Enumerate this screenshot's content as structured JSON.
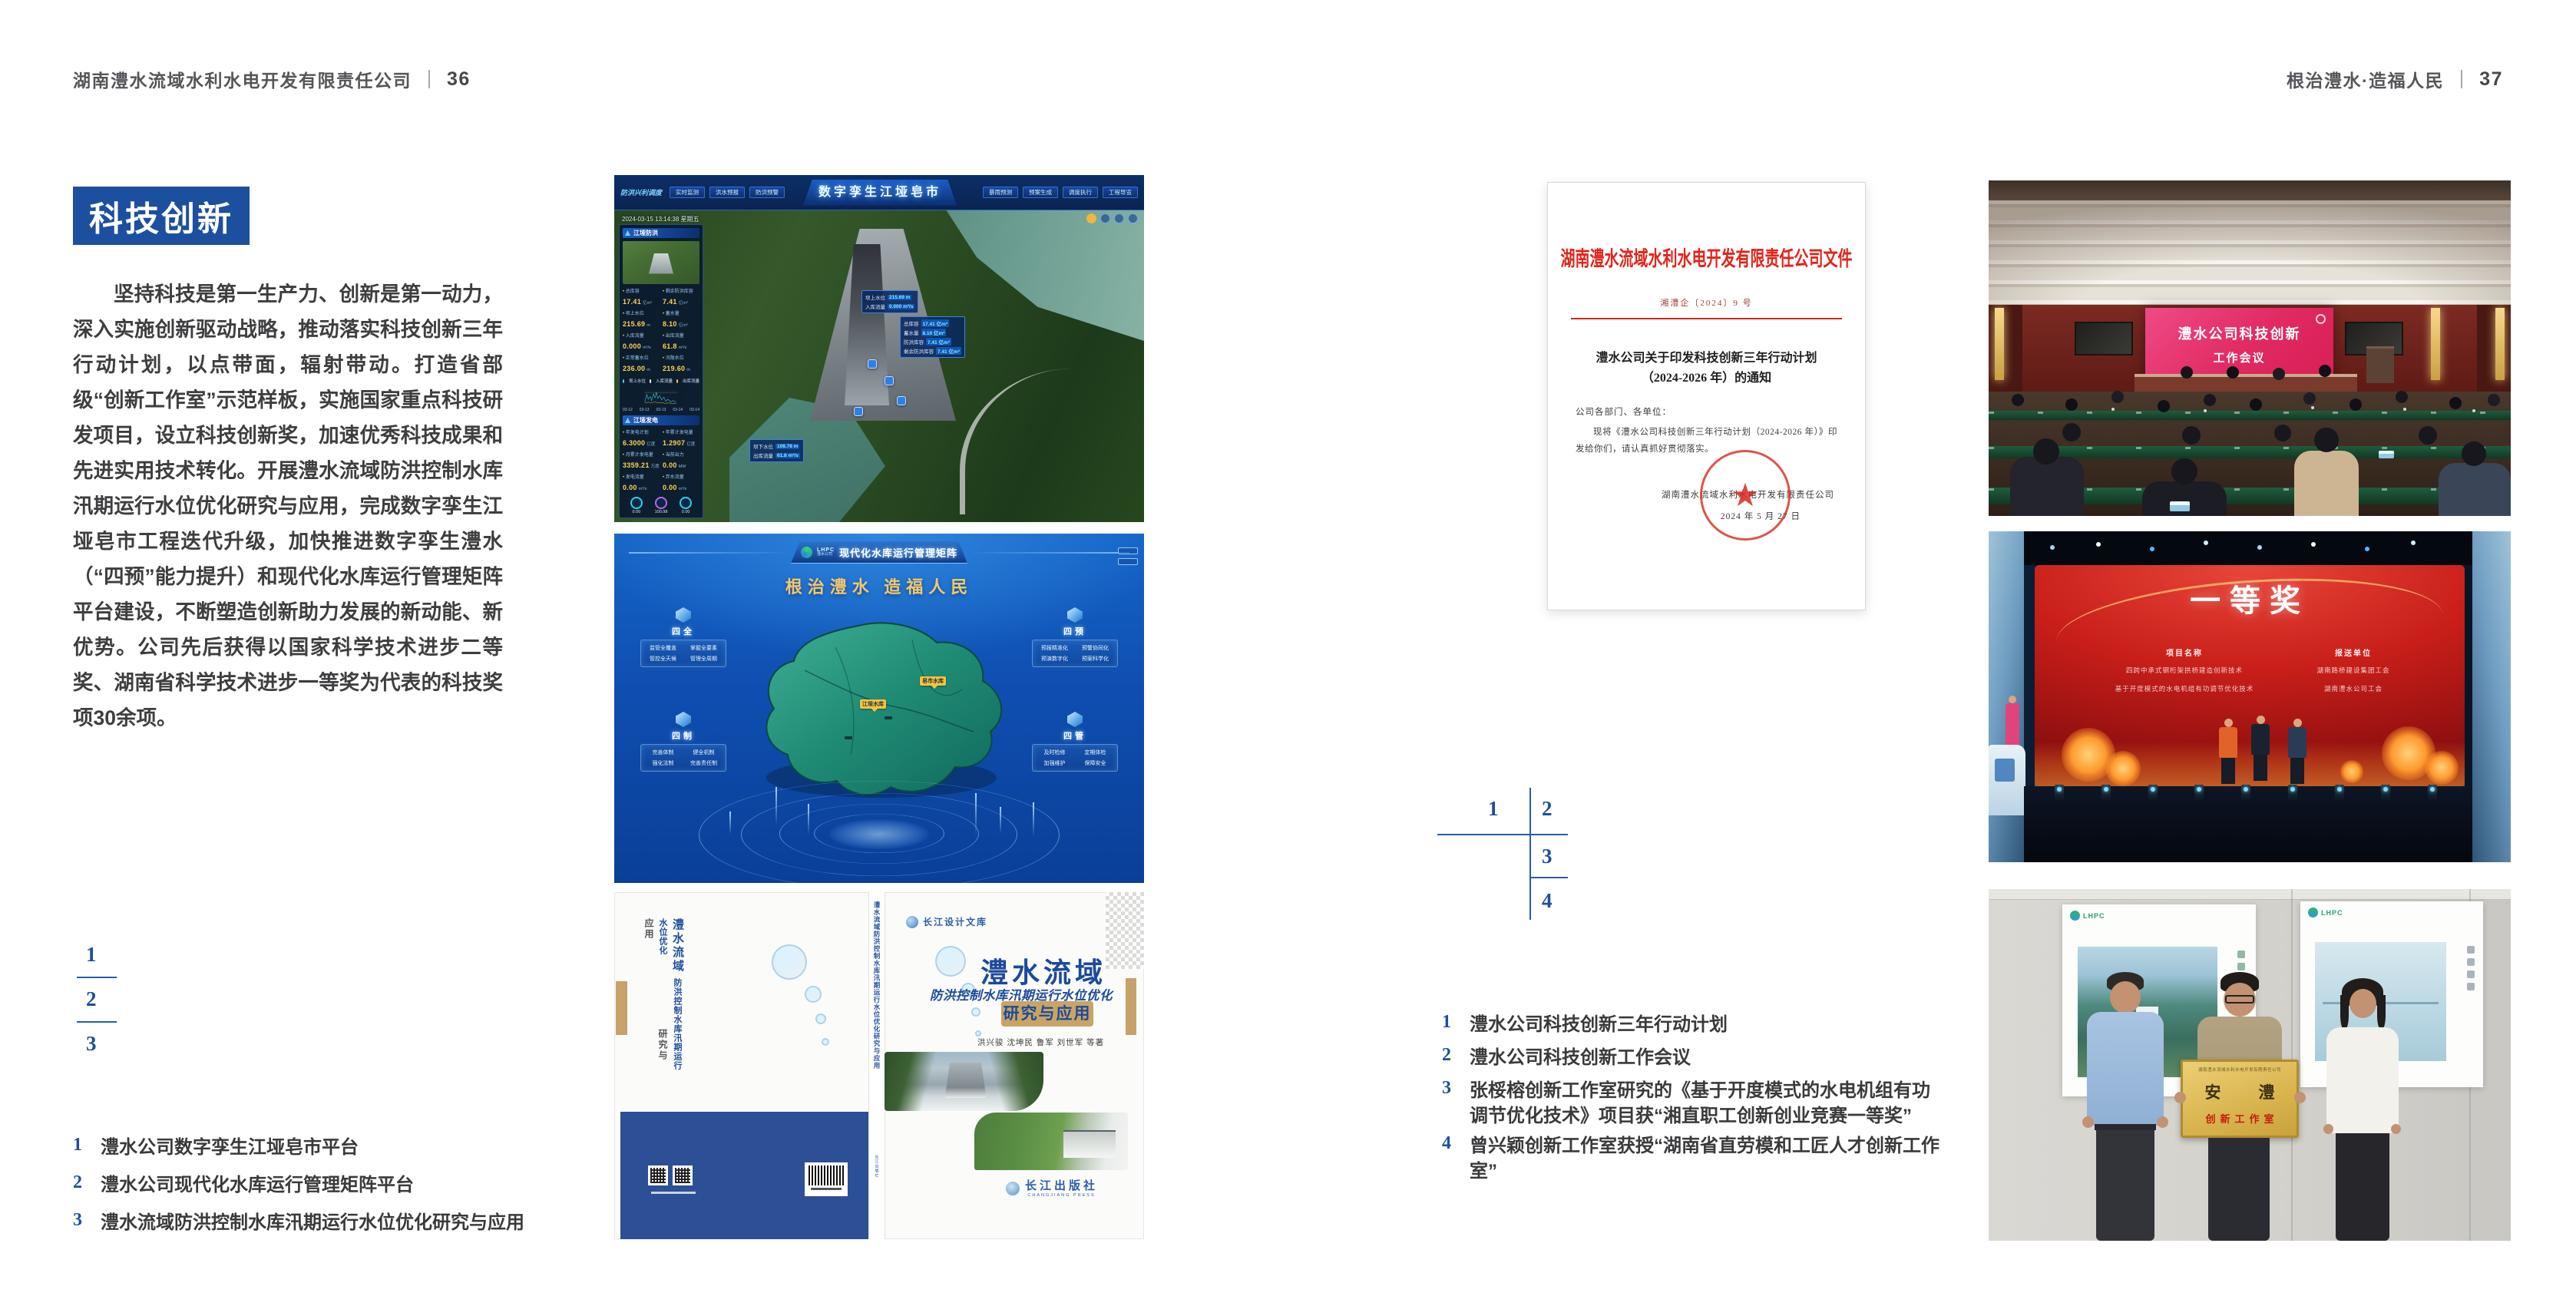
{
  "page_left": {
    "header": "湖南澧水流域水利水电开发有限责任公司",
    "page_no": "36",
    "section_title": "科技创新",
    "body": "坚持科技是第一生产力、创新是第一动力，深入实施创新驱动战略，推动落实科技创新三年行动计划，以点带面，辐射带动。打造省部级“创新工作室”示范样板，实施国家重点科技研发项目，设立科技创新奖，加速优秀科技成果和先进实用技术转化。开展澧水流域防洪控制水库汛期运行水位优化研究与应用，完成数字孪生江垭皂市工程迭代升级，加快推进数字孪生澧水（“四预”能力提升）和现代化水库运行管理矩阵平台建设，不断塑造创新助力发展的新动能、新优势。公司先后获得以国家科学技术进步二等奖、湖南省科学技术进步一等奖为代表的科技奖项30余项。",
    "figure_nums": [
      "1",
      "2",
      "3"
    ],
    "captions": [
      {
        "num": "1",
        "text": "澧水公司数字孪生江垭皂市平台"
      },
      {
        "num": "2",
        "text": "澧水公司现代化水库运行管理矩阵平台"
      },
      {
        "num": "3",
        "text": "澧水流域防洪控制水库汛期运行水位优化研究与应用"
      }
    ]
  },
  "page_right": {
    "header": "根治澧水·造福人民",
    "page_no": "37",
    "figure_nums": [
      "1",
      "2",
      "3",
      "4"
    ],
    "captions": [
      {
        "num": "1",
        "text": "澧水公司科技创新三年行动计划"
      },
      {
        "num": "2",
        "text": "澧水公司科技创新工作会议"
      },
      {
        "num": "3",
        "text": "张桵榕创新工作室研究的《基于开度模式的水电机组有功调节优化技术》项目获“湘直职工创新创业竞赛一等奖”"
      },
      {
        "num": "4",
        "text": "曾兴颖创新工作室获授“湖南省直劳模和工匠人才创新工作室”"
      }
    ]
  },
  "dashboard": {
    "corner_label": "防洪兴利调度",
    "title": "数字孪生江垭皂市",
    "tabs_left": [
      "实时监测",
      "洪水预报",
      "防洪预警"
    ],
    "tabs_right": [
      "暴雨预测",
      "预案生成",
      "调度执行",
      "工程导览"
    ],
    "datetime": "2024-03-15 13:14:38 星期五",
    "panel_flood": {
      "title": "江垭防洪",
      "stats": [
        {
          "label": "总库容",
          "value": "17.41",
          "unit": "亿m³"
        },
        {
          "label": "剩余防洪库容",
          "value": "7.41",
          "unit": "亿m³"
        },
        {
          "label": "坝上水位",
          "value": "215.69",
          "unit": "m"
        },
        {
          "label": "蓄水量",
          "value": "8.10",
          "unit": "亿m³"
        },
        {
          "label": "入库流量",
          "value": "0.000",
          "unit": "m³/s"
        },
        {
          "label": "出库流量",
          "value": "61.8",
          "unit": "m³/s"
        },
        {
          "label": "正常蓄水位",
          "value": "236.00",
          "unit": "m"
        },
        {
          "label": "汛限水位",
          "value": "219.60",
          "unit": "m"
        }
      ],
      "legend": [
        "坝上水位",
        "入库流量",
        "出库流量"
      ],
      "x_ticks": [
        "03-12",
        "03-13",
        "03-13",
        "03-14",
        "03-14"
      ]
    },
    "panel_power": {
      "title": "江垭发电",
      "stats": [
        {
          "label": "年发电计划",
          "value": "6.3000",
          "unit": "亿度"
        },
        {
          "label": "年累计发电量",
          "value": "1.2907",
          "unit": "亿度"
        },
        {
          "label": "月累计发电量",
          "value": "3359.21",
          "unit": "万度"
        },
        {
          "label": "当前出力",
          "value": "0.00",
          "unit": "MW"
        },
        {
          "label": "发电流量",
          "value": "0.00",
          "unit": "m³/s"
        },
        {
          "label": "弃水流量",
          "value": "0.00",
          "unit": "m³/s"
        }
      ],
      "gauges": [
        "0.00",
        "100.98",
        "0.00"
      ]
    },
    "tip_upper": [
      {
        "label": "坝上水位",
        "value": "215.69 m"
      },
      {
        "label": "入库流量",
        "value": "0.000 m³/s"
      }
    ],
    "tip_side": [
      {
        "label": "总库容",
        "value": "17.41 亿m³"
      },
      {
        "label": "蓄水量",
        "value": "8.10 亿m³"
      },
      {
        "label": "防洪库容",
        "value": "7.41 亿m³"
      },
      {
        "label": "剩余防洪库容",
        "value": "7.41 亿m³"
      }
    ],
    "tip_lower": [
      {
        "label": "坝下水位",
        "value": "108.78 m"
      },
      {
        "label": "出库流量",
        "value": "61.8 m³/s"
      }
    ]
  },
  "matrix": {
    "logo_text": "LHPC",
    "logo_sub": "澧水公司",
    "title": "现代化水库运行管理矩阵",
    "slogan": "根治澧水  造福人民",
    "panels": [
      {
        "title": "四全",
        "items": [
          "监管全覆盖",
          "掌握全要素",
          "管控全天候",
          "管理全周期"
        ]
      },
      {
        "title": "四预",
        "items": [
          "预报精准化",
          "预警协同化",
          "预演数字化",
          "预案科学化"
        ]
      },
      {
        "title": "四制",
        "items": [
          "完善体制",
          "健全机制",
          "强化法制",
          "完善责任制"
        ]
      },
      {
        "title": "四管",
        "items": [
          "及时检修",
          "定期体检",
          "加强维护",
          "保障安全"
        ]
      }
    ],
    "markers": [
      "皂市水库",
      "江垭水库"
    ]
  },
  "book": {
    "series": "长江设计文库",
    "title_region": "澧水流域",
    "title_sub": "防洪控制水库汛期运行水位优化",
    "title_tail": "研究与应用",
    "authors": "洪兴骏 沈坤民 鲁军 刘世军 等著",
    "spine": "澧水流域防洪控制水库汛期运行水位优化研究与应用",
    "publisher": "长江出版社",
    "publisher_en": "CHANGJIANG PRESS",
    "back_title_region": "澧水流域",
    "back_title_sub": "防洪控制水库汛期运行水位优化",
    "back_title_tail": "研究与应用"
  },
  "doc": {
    "header": "湖南澧水流域水利水电开发有限责任公司文件",
    "number": "湘澧企〔2024〕9 号",
    "title_line1": "澧水公司关于印发科技创新三年行动计划",
    "title_line2": "（2024-2026 年）的通知",
    "salutation": "公司各部门、各单位：",
    "body": "现将《澧水公司科技创新三年行动计划（2024-2026 年）》印发给你们，请认真抓好贯彻落实。",
    "signer": "湖南澧水流域水利水电开发有限责任公司",
    "date": "2024 年 5 月 27 日"
  },
  "meeting": {
    "screen_line1": "澧水公司科技创新",
    "screen_line2": "工作会议"
  },
  "award": {
    "headline": "一等奖",
    "col_project_header": "项目名称",
    "col_project_rows": [
      "四跨中承式钢桁架拱桥建造创新技术",
      "基于开度模式的水电机组有功调节优化技术"
    ],
    "col_org_header": "报送单位",
    "col_org_rows": [
      "湖南路桥建设集团工会",
      "湖南澧水公司工会"
    ]
  },
  "group": {
    "plaque_header": "湖南澧水流域水利水电开发有限责任公司",
    "plaque_title": "安　澧",
    "plaque_subtitle": "创新工作室",
    "poster_logo": "LHPC"
  }
}
